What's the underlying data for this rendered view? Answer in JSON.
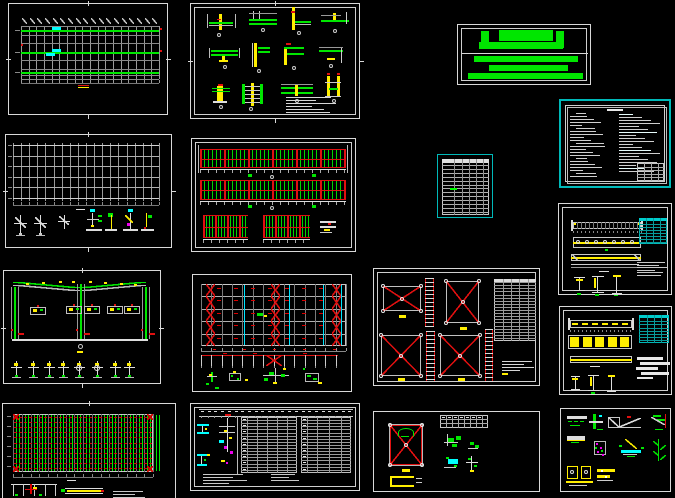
{
  "canvas": {
    "width_px": 675,
    "height_px": 498,
    "background": "#000000",
    "sheet_count": 16
  },
  "palette": {
    "border_white": "#d8d8d8",
    "grid_gray": "#9a9a9a",
    "cad_green": "#00e600",
    "bright_green": "#00ff00",
    "cad_red": "#e01010",
    "cad_yellow": "#ffee00",
    "cad_cyan": "#00ffff",
    "teal_border": "#00b9b9",
    "cad_magenta": "#ee00ee",
    "note_text_gray": "#d6d6d6"
  },
  "sheets": [
    {
      "id": "sheet-roof-framing-plan",
      "semantic": "long rectangular framing plan, green chords, cyan tags, red-yellow title mark"
    },
    {
      "id": "sheet-connection-details",
      "semantic": "12 beam-column connection details, green beams, yellow columns, note block"
    },
    {
      "id": "sheet-green-title-block",
      "semantic": "solid green logo bars inside double white frame"
    },
    {
      "id": "sheet-design-notes",
      "semantic": "teal bordered notes sheet, two columns of fine text, small table"
    },
    {
      "id": "sheet-material-table",
      "semantic": "small teal bordered schedule table with green mark"
    },
    {
      "id": "sheet-foundation-plan",
      "semantic": "foundation grid plan with anchor-bolt details below"
    },
    {
      "id": "sheet-elevations",
      "semantic": "four red/green hatched wall elevation strips with detail"
    },
    {
      "id": "sheet-portal-frame",
      "semantic": "gable portal frame cross-section, green members, base details row"
    },
    {
      "id": "sheet-roof-bracing-plan",
      "semantic": "bracing plan, red X columns, cyan lines, elevation strip, details"
    },
    {
      "id": "sheet-x-bracing-details",
      "semantic": "four red X-brace panels, ladder struts, schedule table, notes"
    },
    {
      "id": "sheet-crane-beam-1",
      "semantic": "crane beam strips with teal table and section details"
    },
    {
      "id": "sheet-crane-beam-2",
      "semantic": "crane beam strips, yellow cells, teal table, stacked bars"
    },
    {
      "id": "sheet-misc-details",
      "semantic": "grid of small green/yellow/cyan/magenta connection details"
    },
    {
      "id": "sheet-purlin-plan",
      "semantic": "dense purlin plan, green verticals, red dashed rows, details (cropped)"
    },
    {
      "id": "sheet-member-schedules",
      "semantic": "two dense schedule tables with colored details at left, notes"
    },
    {
      "id": "sheet-brace-panel-detail",
      "semantic": "red X square, small table, green details, yellow channel"
    }
  ]
}
